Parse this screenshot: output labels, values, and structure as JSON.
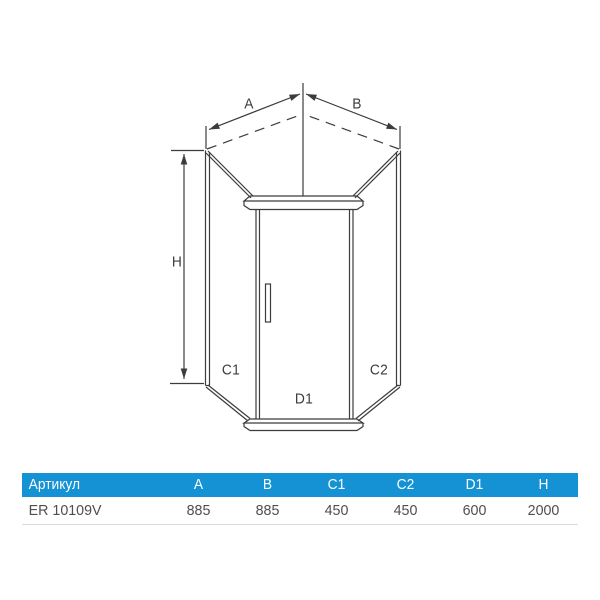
{
  "colors": {
    "header_bg": "#1492D3",
    "header_text": "#FFFFFF",
    "body_text": "#4F4F4F",
    "line": "#3C3C3C",
    "row_divider": "#D9D9D9",
    "background": "#FFFFFF"
  },
  "diagram": {
    "description": "pentagonal corner shower enclosure technical drawing",
    "labels": {
      "A": "A",
      "B": "B",
      "H": "H",
      "C1": "C1",
      "C2": "C2",
      "D1": "D1"
    }
  },
  "table": {
    "headers": [
      "Артикул",
      "A",
      "B",
      "C1",
      "C2",
      "D1",
      "H"
    ],
    "row": {
      "article": "ER 10109V",
      "values": [
        "885",
        "885",
        "450",
        "450",
        "600",
        "2000"
      ]
    }
  }
}
